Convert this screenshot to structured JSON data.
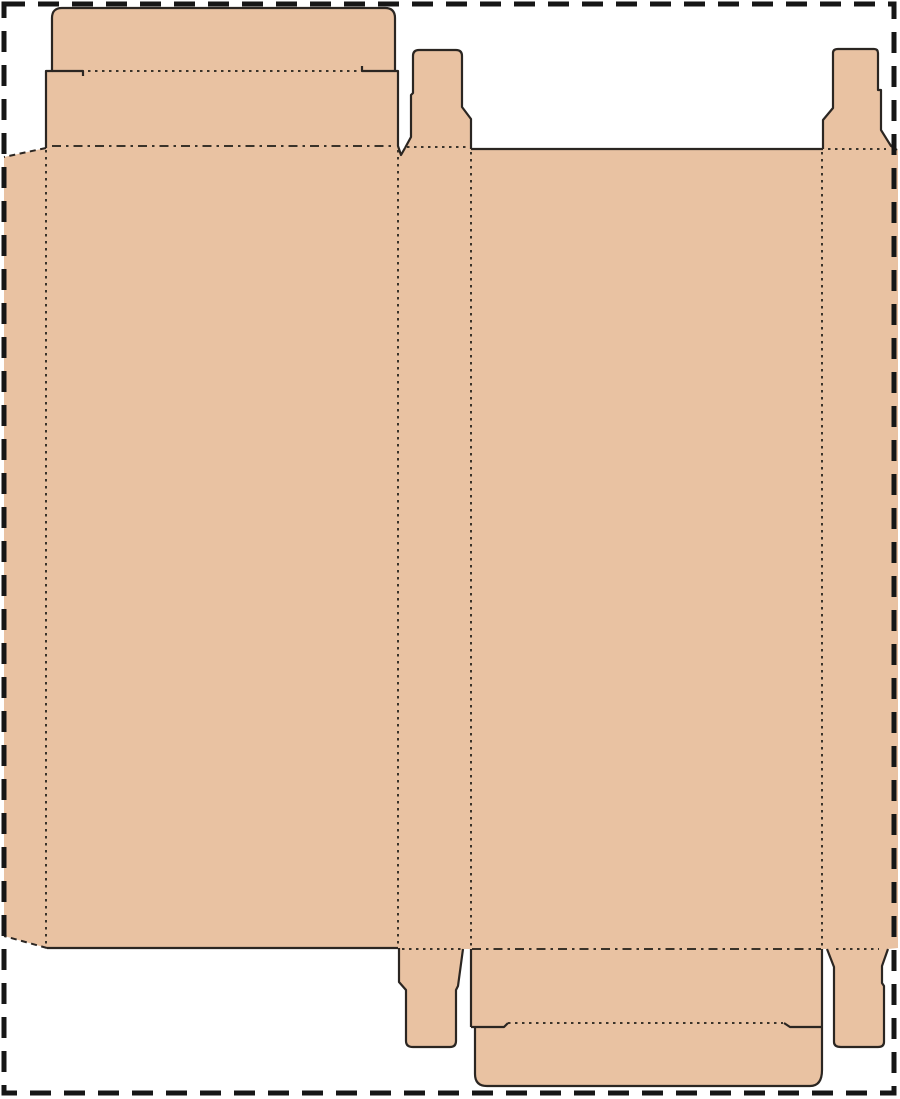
{
  "canvas": {
    "width": 900,
    "height": 1099,
    "background_color": "#ffffff"
  },
  "colors": {
    "board_fill": "#E9C2A2",
    "cut_line": "#2b2622",
    "fold_line": "#3a332a",
    "trim_border": "#161616"
  },
  "line_widths": {
    "cut": 2.2,
    "fold": 2.0,
    "perforation": 2.0,
    "trim_border": 5.0
  },
  "dash_patterns": {
    "trim_border": "21 13",
    "fold_fine": "2.5 4.5",
    "fold_dash_dot": "9 5 2.5 5",
    "perforation": "6 4.5"
  },
  "page_border": {
    "x": 4,
    "y": 4,
    "width": 890,
    "height": 1089
  },
  "dieline": {
    "silhouette_path": "M4,936 L4,157 L46,148 L46,71 L52,71 L52,18 Q52,8 62,8 L385,8 Q395,8 395,18 L395,71 L398,71 L398,146 L401,155 L405,148 L411,137 L411,95 L413,93 L413,56 Q413,50 419,50 L456,50 Q462,50 462,56 L462,107 L471,119 L471,149 L823,149 L823,120 L833,108 L833,53 Q833,49 838,49 L874,49 Q878,49 878,53 L878,90 L881,90 L881,130 L891,146 L898,150 L898,948 L888,949 L882,966 L882,983 L884,986 L884,1042 Q884,1047 878,1047 L841,1047 Q834,1047 834,1042 L834,967 L827,949 L822,949 L822,1070 Q822,1086 810,1086 L487,1086 Q475,1086 475,1074 L475,1027 L471,1027 L471,949 L463,949 L458,986 L456,990 L456,1041 Q456,1047 450,1047 L413,1047 Q406,1047 406,1041 L406,990 L399,982 L399,948 L47,948 Z",
    "cut_paths": [
      {
        "name": "top-tuck-and-lid-outline",
        "d": "M46,148 L46,71 L52,71 L52,18 Q52,8 62,8 L385,8 Q395,8 395,18 L395,71 L398,71 L398,146 L401,155 L405,148"
      },
      {
        "name": "top-dust-flap-center-outline",
        "d": "M405,148 L411,137 L411,95 L413,93 L413,56 Q413,50 419,50 L456,50 Q462,50 462,56 L462,107 L471,119 L471,149"
      },
      {
        "name": "back-panel-top-edge",
        "d": "M471,149 L823,149"
      },
      {
        "name": "top-dust-flap-right-outline",
        "d": "M823,149 L823,120 L833,108 L833,53 Q833,49 838,49 L874,49 Q878,49 878,53 L878,90 L881,90 L881,130 L891,146 L897,150"
      },
      {
        "name": "top-tuck-slit-left",
        "d": "M52,71 L83,71 L83,76"
      },
      {
        "name": "top-tuck-slit-right",
        "d": "M395,71 L362,71 L362,66"
      },
      {
        "name": "front-panel-bottom-edge",
        "d": "M47,948 L398,948"
      },
      {
        "name": "bottom-dust-flap-center-outline",
        "d": "M399,948 L399,982 L406,990 L406,1041 Q406,1047 413,1047 L450,1047 Q456,1047 456,1041 L456,990 L458,986 L463,949"
      },
      {
        "name": "bottom-lid-left-edge",
        "d": "M471,949 L471,1027"
      },
      {
        "name": "bottom-tuck-outline",
        "d": "M475,1027 L475,1074 Q475,1086 487,1086 L810,1086 Q822,1086 822,1070 L822,949"
      },
      {
        "name": "bottom-tuck-slit-left",
        "d": "M471,1027 L504,1027 L508,1023"
      },
      {
        "name": "bottom-tuck-slit-right",
        "d": "M822,1027 L790,1027 L784,1023"
      },
      {
        "name": "bottom-dust-flap-right-outline",
        "d": "M827,949 L834,967 L834,1042 Q834,1047 841,1047 L878,1047 Q884,1047 884,1042 L884,986 L882,983 L882,966 L888,949"
      }
    ],
    "fold_paths": [
      {
        "name": "top-tuck-fold",
        "d": "M88,71 L358,71",
        "dash": "fold_fine"
      },
      {
        "name": "front-panel-top-fold",
        "d": "M52,146 L393,146",
        "dash": "fold_dash_dot"
      },
      {
        "name": "top-dust-flap-center-fold",
        "d": "M407,147 L466,147",
        "dash": "fold_fine"
      },
      {
        "name": "top-dust-flap-right-fold",
        "d": "M828,149 L886,149",
        "dash": "fold_fine"
      },
      {
        "name": "glue-flap-vertical-fold",
        "d": "M46,150 L46,946",
        "dash": "fold_fine"
      },
      {
        "name": "front-side-vertical-fold",
        "d": "M398,150 L398,946",
        "dash": "fold_fine"
      },
      {
        "name": "side-back-vertical-fold",
        "d": "M471,152 L471,947",
        "dash": "fold_fine"
      },
      {
        "name": "back-right-vertical-fold",
        "d": "M822,152 L822,946",
        "dash": "fold_fine"
      },
      {
        "name": "bottom-dust-flap-center-fold",
        "d": "M402,949 L461,949",
        "dash": "fold_fine"
      },
      {
        "name": "back-panel-bottom-fold",
        "d": "M472,949 L821,949",
        "dash": "fold_dash_dot"
      },
      {
        "name": "bottom-dust-flap-right-fold",
        "d": "M836,949 L879,949",
        "dash": "fold_fine"
      },
      {
        "name": "bottom-tuck-fold",
        "d": "M508,1023 L783,1023",
        "dash": "fold_fine"
      }
    ],
    "perforation_paths": [
      {
        "name": "glue-flap-top-edge",
        "d": "M46,148 L4,157"
      },
      {
        "name": "glue-flap-bottom-edge",
        "d": "M47,948 L4,936"
      }
    ]
  }
}
